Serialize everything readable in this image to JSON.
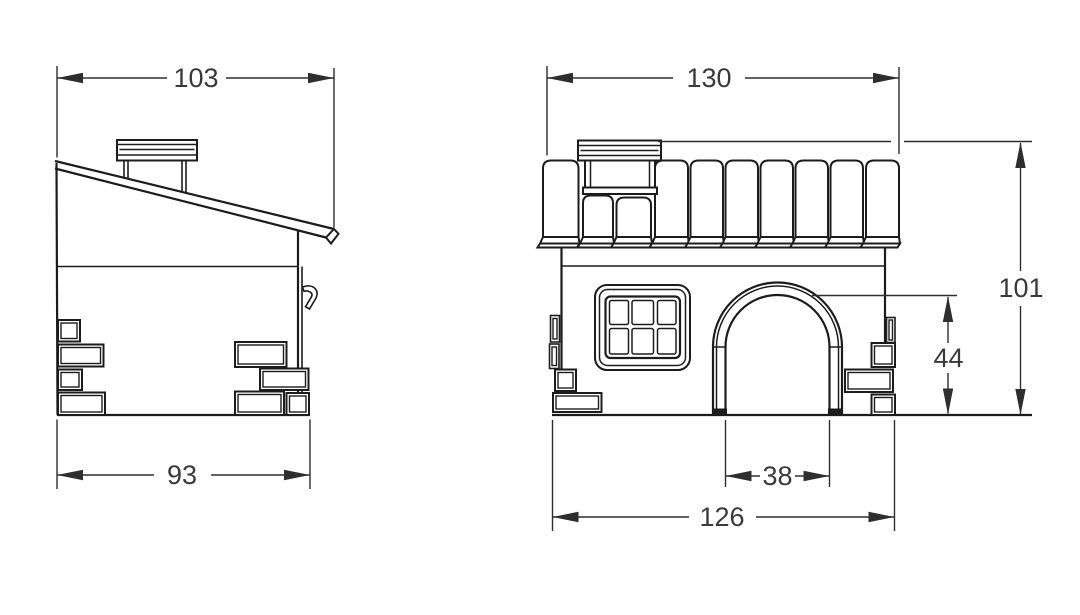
{
  "dims": {
    "side": {
      "overall_width": "103",
      "base_width": "93"
    },
    "front": {
      "roof_width": "130",
      "overall_height": "101",
      "door_height": "44",
      "door_width": "38",
      "base_width": "126"
    }
  },
  "colors": {
    "line": "#1c1c1c",
    "dimension": "#2e2e2e",
    "text": "#3a3a3a",
    "background": "#ffffff"
  }
}
